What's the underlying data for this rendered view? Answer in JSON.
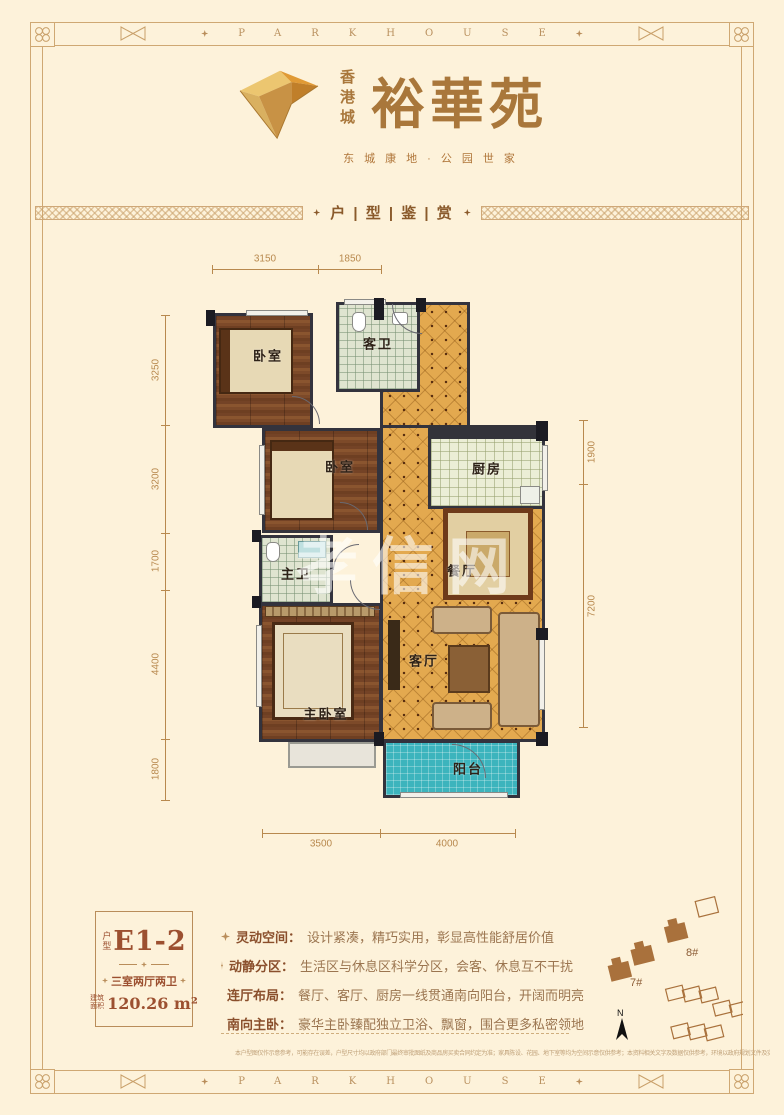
{
  "page": {
    "bg": "#fdf2da",
    "accent": "#b98d5a",
    "text_brown": "#8a4f2c"
  },
  "frame": {
    "brand": "PARKHOUSE"
  },
  "logo": {
    "city": "香港城",
    "name": "裕華苑",
    "tagline": "东城康地·公园世家"
  },
  "section": {
    "title": "户 | 型 | 鉴 | 赏"
  },
  "floorplan": {
    "watermark": "孝信网",
    "rooms": [
      {
        "label": "卧室"
      },
      {
        "label": "客卫"
      },
      {
        "label": "卧室"
      },
      {
        "label": "厨房"
      },
      {
        "label": "主卫"
      },
      {
        "label": "餐厅"
      },
      {
        "label": "客厅"
      },
      {
        "label": "主卧室"
      },
      {
        "label": "阳台"
      }
    ],
    "dims": {
      "top": [
        "3150",
        "1850"
      ],
      "left": [
        "3250",
        "3200",
        "1700",
        "4400",
        "1800"
      ],
      "right": [
        "1900",
        "7200"
      ],
      "bottom": [
        "3500",
        "4000"
      ]
    }
  },
  "unit_card": {
    "type_label": "户型",
    "unit": "E1-2",
    "layout": "三室两厅两卫",
    "area_label": "建筑面积",
    "area_value": "120.26 m²"
  },
  "features": [
    {
      "title": "灵动空间：",
      "desc": "设计紧凑，精巧实用，彰显高性能舒居价值"
    },
    {
      "title": "动静分区：",
      "desc": "生活区与休息区科学分区，会客、休息互不干扰"
    },
    {
      "title": "连厅布局：",
      "desc": "餐厅、客厅、厨房一线贯通南向阳台，开阔而明亮"
    },
    {
      "title": "南向主卧：",
      "desc": "豪华主卧臻配独立卫浴、飘窗，围合更多私密领地"
    }
  ],
  "sitemap": {
    "building_a": "7#",
    "building_b": "8#",
    "north": "N"
  },
  "disclaimer": "本户型图仅作示意参考，可能存在误差，户型尺寸均以政府部门最终审批图纸及商品房买卖合同约定为准；家具陈设、花园、地下室等均为空间示意仅供参考；本资料相关文字及数据仅供参考，环境以政府规划文件及实景为准。"
}
